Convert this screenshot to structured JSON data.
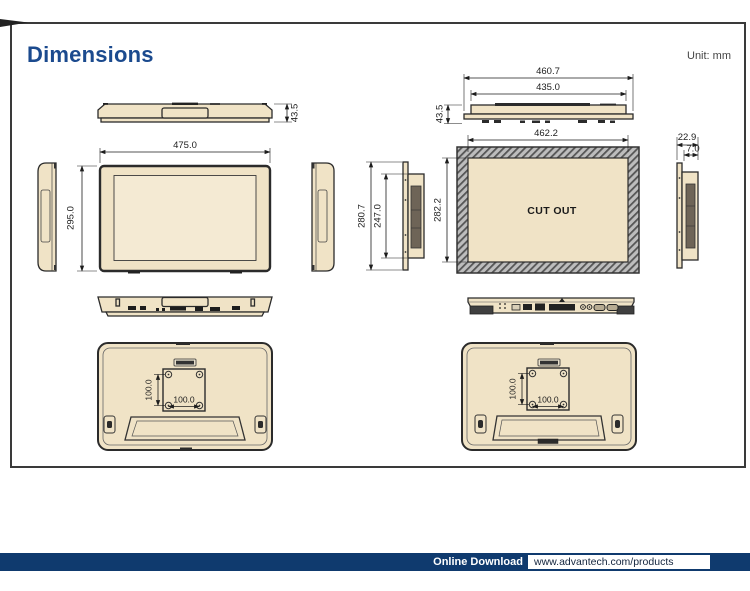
{
  "page": {
    "title": "Dimensions",
    "unit_label": "Unit: mm"
  },
  "footer": {
    "download_label": "Online Download",
    "url": "www.advantech.com/products"
  },
  "colors": {
    "accent_blue": "#1b4a8e",
    "footer_bar_blue": "#0f3a6e",
    "device_beige": "#f0e3c6",
    "outline_dark": "#2b2b2b",
    "hatch_gray": "#bdbdbd"
  },
  "dims": {
    "top_view": {
      "height": "43.5"
    },
    "front": {
      "width": "475.0",
      "height": "295.0"
    },
    "rear_top": {
      "outer_width": "460.7",
      "body_width": "435.0",
      "height": "43.5"
    },
    "cutout": {
      "width": "462.2",
      "height": "282.2",
      "label": "CUT OUT"
    },
    "side": {
      "flange_height": "280.7",
      "body_height": "247.0"
    },
    "side_profile": {
      "total_depth": "22.9",
      "rear_depth": "7.0"
    },
    "vesa": {
      "width": "100.0",
      "height": "100.0"
    }
  }
}
